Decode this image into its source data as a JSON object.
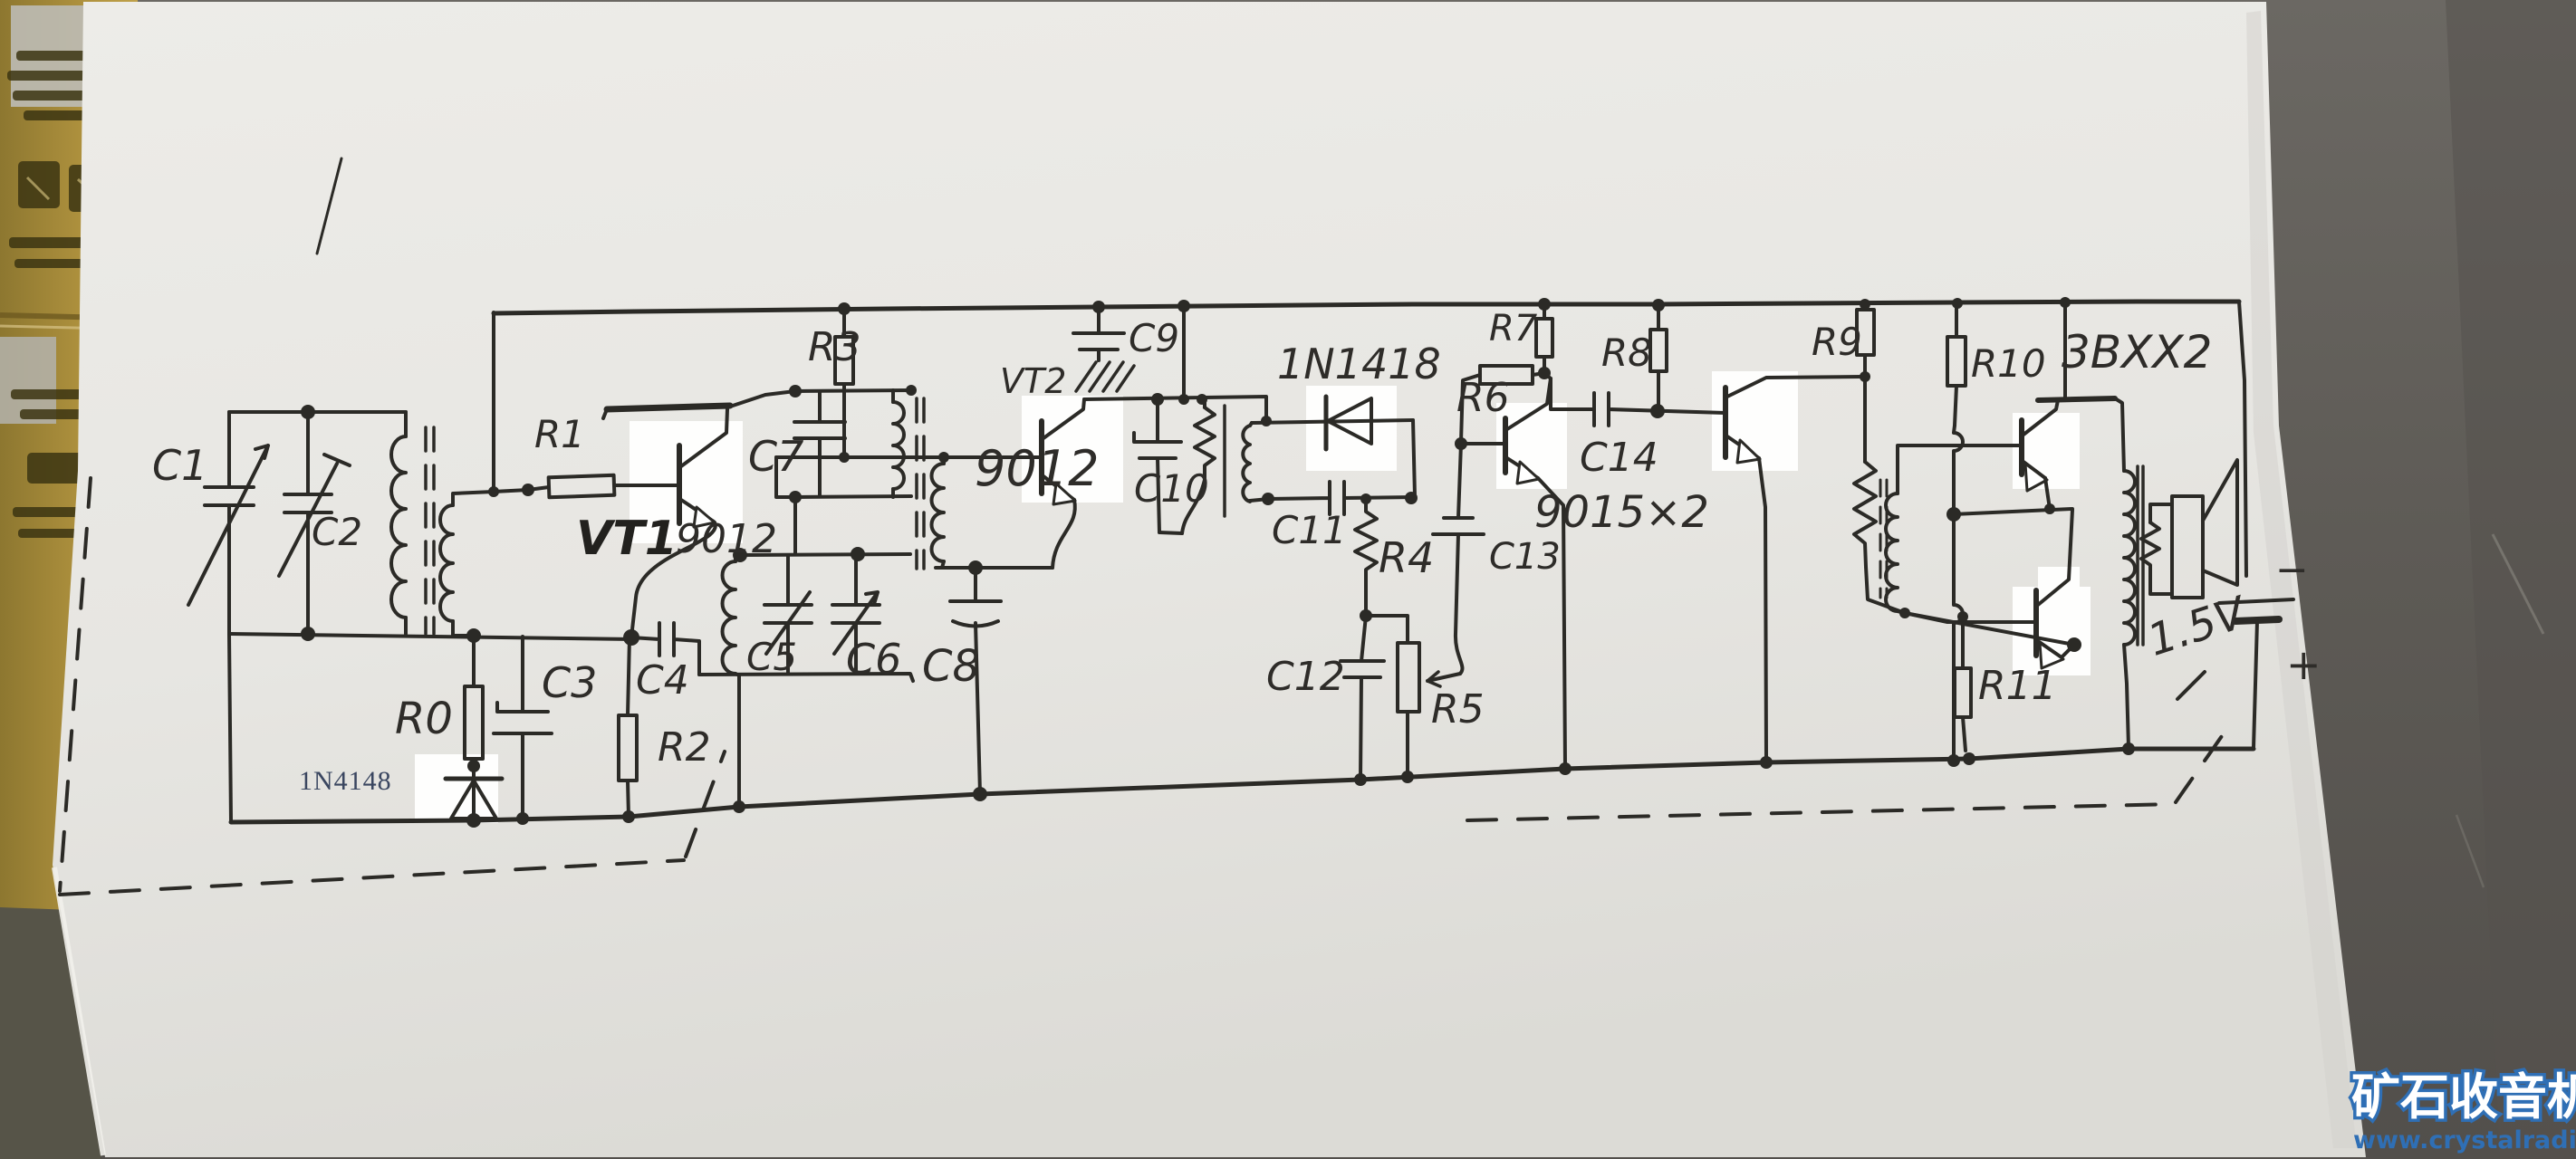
{
  "scene": {
    "type": "photograph of a hand-drawn transistor radio circuit schematic on white paper",
    "background": "dark gray table at right, gold cardboard box at left under the paper"
  },
  "labels": {
    "c1": "C1",
    "c2": "C2",
    "c3": "C3",
    "c4": "C4",
    "c5": "C5",
    "c6": "C6",
    "c7": "C7",
    "c8": "C8",
    "c9": "C9",
    "c10": "C10",
    "c11": "C11",
    "c12": "C12",
    "c13": "C13",
    "c14": "C14",
    "r0": "R0",
    "r1": "R1",
    "r2": "R2",
    "r3": "R3",
    "r4": "R4",
    "r5": "R5",
    "r6": "R6",
    "r7": "R7",
    "r8": "R8",
    "r9": "R9",
    "r10": "R10",
    "r11": "R11",
    "vt1": "VT1",
    "vt1_type": "9012",
    "vt2": "VT2",
    "vt2_type": "9012",
    "d1": "1N4148",
    "d2": "1N1418",
    "af_pair": "9015×2",
    "out_pair": "3BXX2",
    "battery_voltage": "1.5V",
    "battery_plus": "+",
    "battery_minus": "−"
  },
  "watermark": {
    "site_name": "矿石收音机",
    "site_url": "www.crystalradio.cn"
  },
  "components": [
    {
      "designator": "C1",
      "type": "variable-capacitor"
    },
    {
      "designator": "C2",
      "type": "trimmer-capacitor"
    },
    {
      "designator": "C5",
      "type": "trimmer-capacitor"
    },
    {
      "designator": "C6",
      "type": "variable-capacitor"
    },
    {
      "designator": "R5",
      "type": "potentiometer"
    },
    {
      "designator": "VT1",
      "type": "transistor 9012"
    },
    {
      "designator": "VT2",
      "type": "transistor 9012"
    },
    {
      "designator": "AF",
      "type": "two transistors 9015"
    },
    {
      "designator": "OUT",
      "type": "two output transistors 3BXX2"
    },
    {
      "designator": "D1",
      "type": "diode 1N4148"
    },
    {
      "designator": "D2",
      "type": "diode 1N1418"
    },
    {
      "designator": "BT",
      "type": "battery 1.5V"
    },
    {
      "designator": "SP",
      "type": "loudspeaker"
    }
  ],
  "colors": {
    "ink": "#2b2a26",
    "paper": "#e9e8e4",
    "background_dark": "#5f5c57",
    "cardboard_gold": "#ad8f3e",
    "watermark_blue": "#2f6fb5",
    "printed_label_navy": "#3a4660"
  }
}
